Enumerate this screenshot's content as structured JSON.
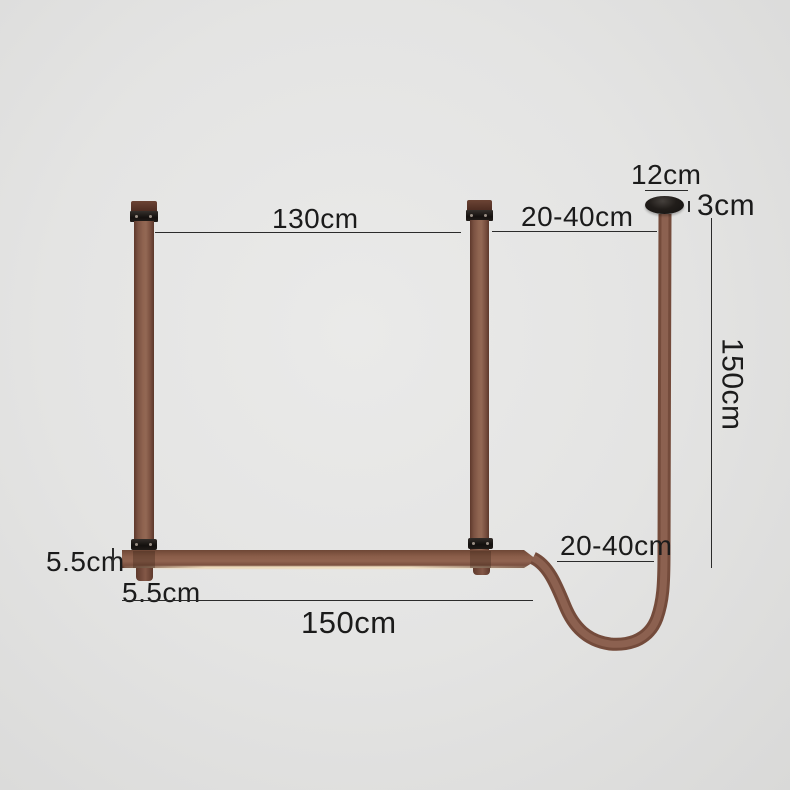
{
  "diagram": {
    "dimensions": {
      "top_span": "130cm",
      "top_offset": "20-40cm",
      "canopy_diameter": "12cm",
      "canopy_thickness": "3cm",
      "drop_length": "150cm",
      "side_offset": "20-40cm",
      "bar_thickness": "5.5cm",
      "strap_width": "5.5cm",
      "bar_length": "150cm"
    },
    "colors": {
      "background": "#e4e4e3",
      "background_edge": "#d9d9d8",
      "strap_brown": "#8a6150",
      "strap_dark": "#5e392c",
      "bar_highlight": "#ecd9ba",
      "hardware_black": "#15110f",
      "dimension_line": "#2b2b2b",
      "text": "#1b1b1b"
    }
  }
}
